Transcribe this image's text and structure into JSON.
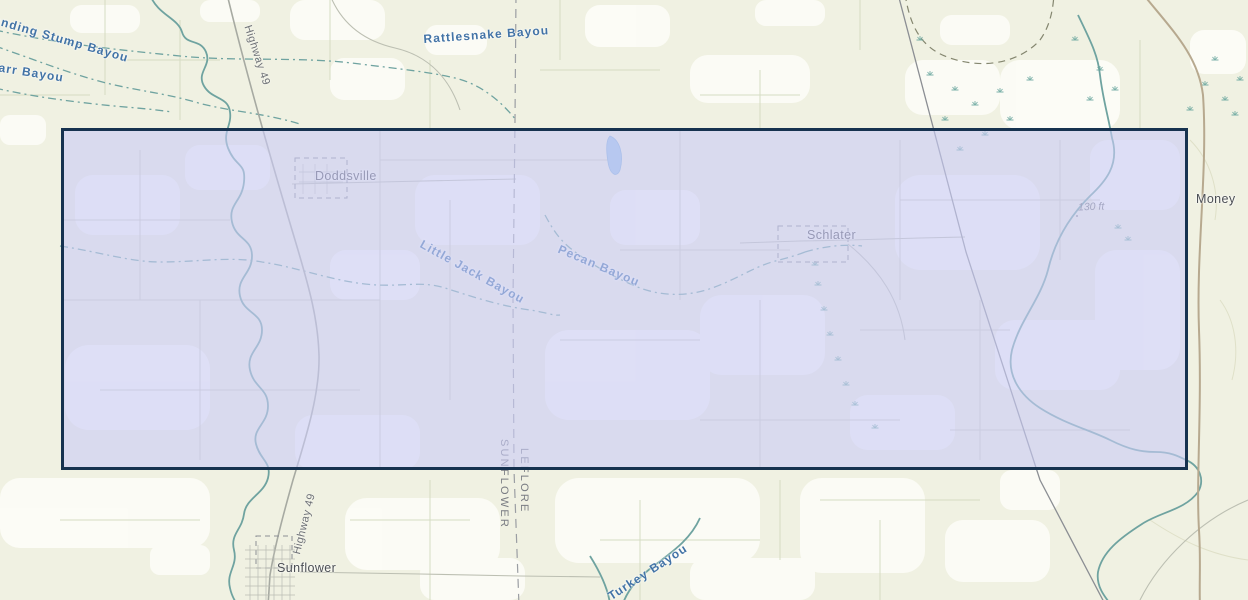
{
  "map": {
    "water_labels": {
      "standing_stump": "Standing Stump Bayou",
      "darr": "Darr Bayou",
      "rattlesnake": "Rattlesnake Bayou",
      "little_jack": "Little Jack Bayou",
      "pecan": "Pecan Bayou",
      "turkey": "Turkey Bayou"
    },
    "place_labels": {
      "doddsville": "Doddsville",
      "schlater": "Schlater",
      "sunflower": "Sunflower",
      "money": "Money"
    },
    "road_labels": {
      "highway_north": "Highway 49",
      "highway_south": "Highway 49"
    },
    "county_labels": {
      "west": "SUNFLOWER",
      "east": "LEFLORE"
    },
    "elevation_label": "130 ft",
    "selection": {
      "x": 61,
      "y": 128,
      "width": 1127,
      "height": 342
    },
    "colors": {
      "background": "#f0f1e2",
      "white_patch": "#fdfdf8",
      "water": "#6fa3a0",
      "water_label": "#4273a6",
      "place_label": "#4b4e54",
      "road": "#a7aaa2",
      "railroad": "#8b8e93",
      "tan_road": "#b7a98f",
      "county_line": "#9b9ea3",
      "selection_fill": "rgba(202,204,246,0.6)",
      "selection_border": "#16324f",
      "pond": "#9cc3e6"
    }
  }
}
